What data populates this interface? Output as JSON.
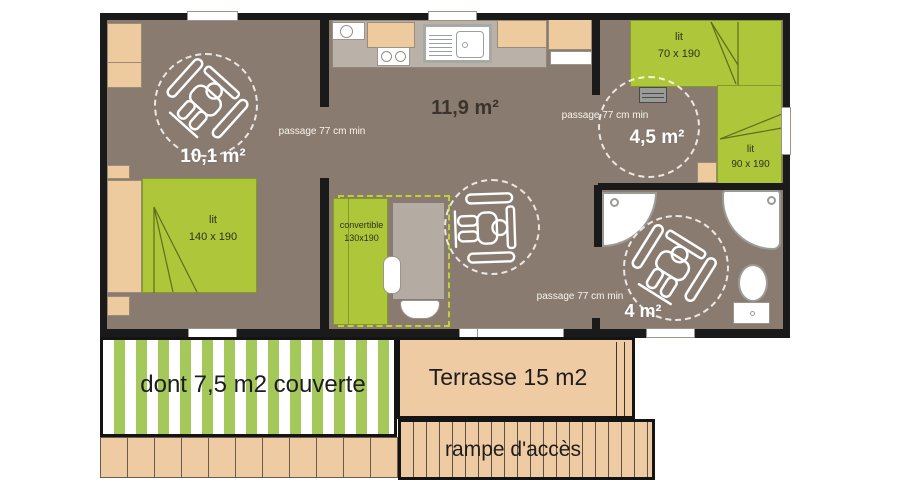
{
  "plan": {
    "rooms": {
      "bedroom_main": {
        "area_label": "10,1 m²"
      },
      "living_kitchen": {
        "area_label": "11,9 m²"
      },
      "bedroom_second": {
        "area_label": "4,5 m²"
      },
      "bathroom": {
        "area_label": "4 m²"
      }
    },
    "furniture": {
      "bed_double": {
        "name": "lit",
        "dimensions": "140 x 190"
      },
      "bed_70": {
        "name": "lit",
        "dimensions": "70 x 190"
      },
      "bed_90": {
        "name": "lit",
        "dimensions": "90 x 190"
      },
      "sofa_convertible": {
        "name": "convertible",
        "dimensions": "130x190"
      }
    },
    "notes": {
      "passage_min": "passage 77 cm min"
    },
    "outdoor": {
      "covered_terrace": "dont 7,5 m2 couverte",
      "terrace": "Terrasse 15 m2",
      "ramp": "rampe d'accès"
    },
    "icons": {
      "wheelchair": "wheelchair-top-view (white outline svg)",
      "turning_radius": "dashed-white-circle",
      "shower_corner": "quarter-circle-tray",
      "shower_square": "rounded-square-tray",
      "toilet": "oval-bowl-with-tank"
    },
    "colors": {
      "floor": "#8a7b71",
      "wall": "#1a1a1a",
      "bed_green": "#aec639",
      "wood_beige": "#eeca9f",
      "counter_gray": "#bab1a9",
      "terrace_tan": "#efcba3",
      "stripe_green": "#a5c85a"
    }
  }
}
